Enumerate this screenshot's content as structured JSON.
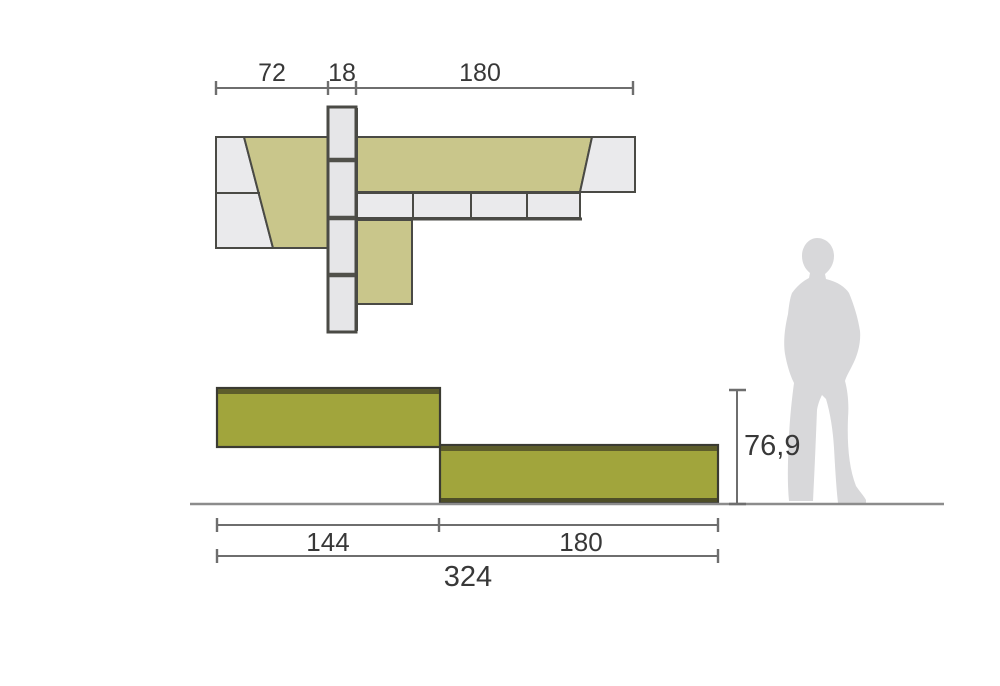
{
  "drawing": {
    "kind": "furniture-dimension-drawing",
    "top_view": {
      "dim_left": "72",
      "dim_center": "18",
      "dim_right": "180"
    },
    "front_view": {
      "height": "76,9",
      "width_left": "144",
      "width_right": "180",
      "width_total": "324"
    },
    "colors": {
      "background": "#ffffff",
      "khaki_top": "#c9c68b",
      "panel_gray": "#eaeaec",
      "spine_gray": "#e6e6e8",
      "olive_front": "#a1a53c",
      "olive_dark": "#5d5d2b",
      "plinth_dark": "#4e4e28",
      "silhouette_gray": "#d8d8da"
    }
  }
}
